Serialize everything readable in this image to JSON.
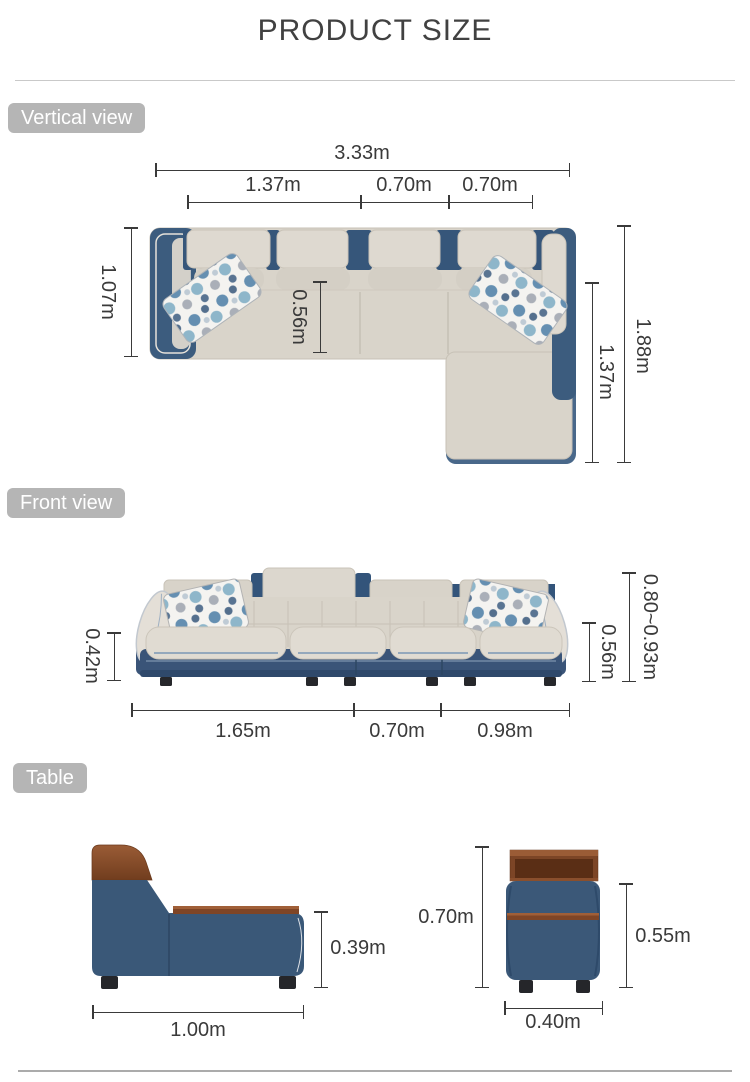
{
  "title": "PRODUCT SIZE",
  "sections": {
    "vertical_view": {
      "badge": "Vertical view",
      "dimensions": {
        "total_width": "3.33m",
        "left_seat_width": "1.37m",
        "middle_seat_width": "0.70m",
        "right_seat_width": "0.70m",
        "sofa_depth": "1.07m",
        "seat_depth": "0.56m",
        "total_depth_with_chaise": "1.88m",
        "chaise_length": "1.37m"
      }
    },
    "front_view": {
      "badge": "Front view",
      "dimensions": {
        "seat_height": "0.42m",
        "armrest_height": "0.56m",
        "back_height_range": "0.80~0.93m",
        "left_section_width": "1.65m",
        "middle_section_width": "0.70m",
        "chaise_section_width": "0.98m"
      }
    },
    "table": {
      "badge": "Table",
      "dimensions": {
        "side_height": "0.39m",
        "side_length": "1.00m",
        "total_height": "0.70m",
        "body_height": "0.55m",
        "width": "0.40m"
      }
    }
  },
  "colors": {
    "badge_bg": "#b5b5b5",
    "dim": "#3a3a3a",
    "sofa_fabric": "#d9d4ca",
    "sofa_fabric_light": "#e3dfd7",
    "sofa_blue": "#3c5c7e",
    "wood": "#8a4f2d",
    "leg": "#26272b",
    "divider": "#c9c9c9"
  }
}
